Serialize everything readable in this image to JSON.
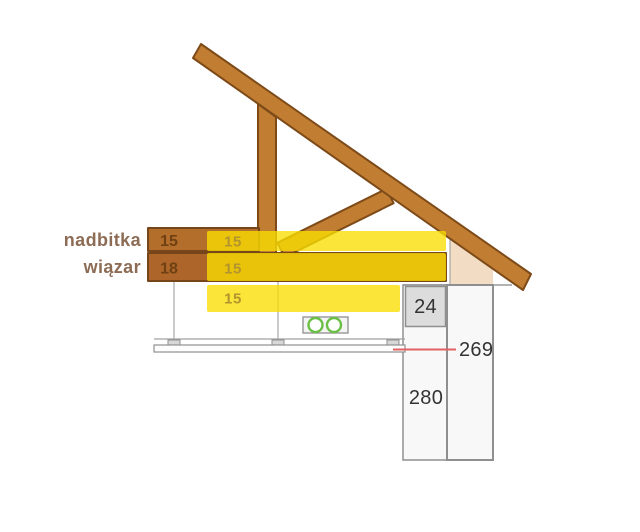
{
  "diagram": {
    "title": "roof truss / ceiling insulation cross-section",
    "labels": {
      "beam_top": "nadbitka",
      "beam_bottom": "wiązar"
    },
    "beams": {
      "top_thickness": "15",
      "bottom_thickness": "18"
    },
    "insulation": {
      "layer1": "15",
      "layer2": "15",
      "layer3": "15"
    },
    "dimensions": {
      "wall_block": "24",
      "ceiling_level": "269",
      "wall_height": "280"
    },
    "colors": {
      "wood": "#c17e33",
      "wood_outline": "#7d4a18",
      "beam_top_fill": "#b46e2c",
      "beam_bottom_fill": "#ad6529",
      "insulation": "#f9de00",
      "insulation_text": "#b2952e",
      "beam_text": "#6e4012",
      "side_label_text": "#8d6c55",
      "dimension_text": "#333333",
      "dim_line_red": "#e26262",
      "conduit_green": "#6abf45",
      "structure_gray": "#9a9a9a",
      "wall_plate_beige": "#f2ddc4",
      "block_gray": "#dcdcdc"
    }
  }
}
